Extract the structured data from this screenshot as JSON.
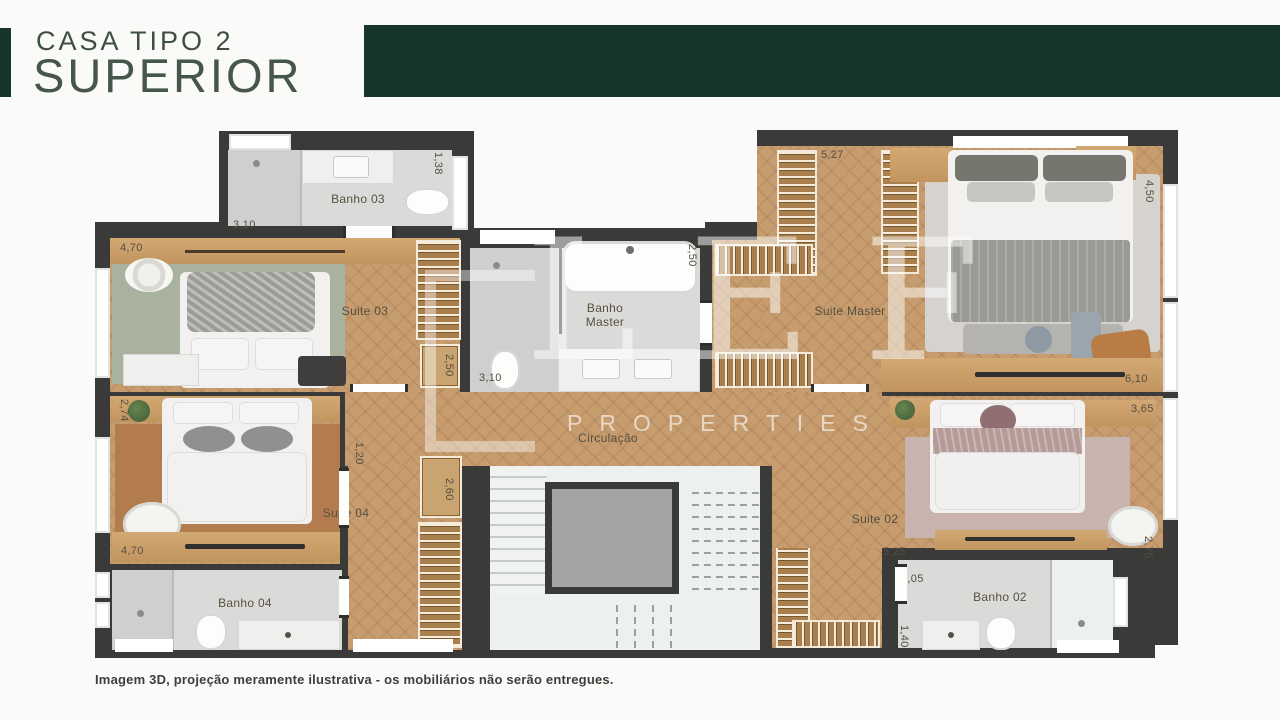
{
  "header": {
    "eyebrow": "CASA TIPO 2",
    "title": "SUPERIOR"
  },
  "plan": {
    "labels": {
      "banho03": "Banho 03",
      "suite03": "Suite 03",
      "banho_master": "Banho\nMaster",
      "suite_master": "Suite Master",
      "circulacao": "Circulação",
      "suite04": "Suite 04",
      "banho04": "Banho 04",
      "suite02": "Suite 02",
      "banho02": "Banho 02"
    },
    "dims": {
      "banho03_width": "3,10",
      "banho03_len": "1,38",
      "suite03_width": "4,70",
      "suite03_closet_len": "2,50",
      "banho_master_len": "2,50",
      "banho_master_width": "3,10",
      "master_closet_width": "5,27",
      "suite_master_len": "4,50",
      "suite_master_width": "6,10",
      "suite02_shelf_width": "3,65",
      "suite04_len": "2,74",
      "hall_width": "1,20",
      "suite04_closet_len": "2,60",
      "suite04_width": "4,70",
      "suite02_hall_len": "7,20",
      "suite02_closet_len": "2,95",
      "suite02_width": "5,25",
      "suite02_len": "2,75",
      "banho02_width": "3,05",
      "banho02_len": "1,40"
    }
  },
  "watermark": {
    "monogram": "LEF",
    "word": "PROPERTIES"
  },
  "footer": {
    "disclaimer": "Imagem 3D, projeção meramente ilustrativa - os mobiliários não serão entregues."
  },
  "colors": {
    "brand_green": "#17352a",
    "wall": "#3a3a38",
    "wood_floor": "#c79d70",
    "bath_floor": "#dadbd9",
    "rug_suite03": "#a9b29f",
    "rug_suite04": "#b37c4f",
    "rug_suite02": "#c9b3ae",
    "marble": "#edf0f0"
  }
}
